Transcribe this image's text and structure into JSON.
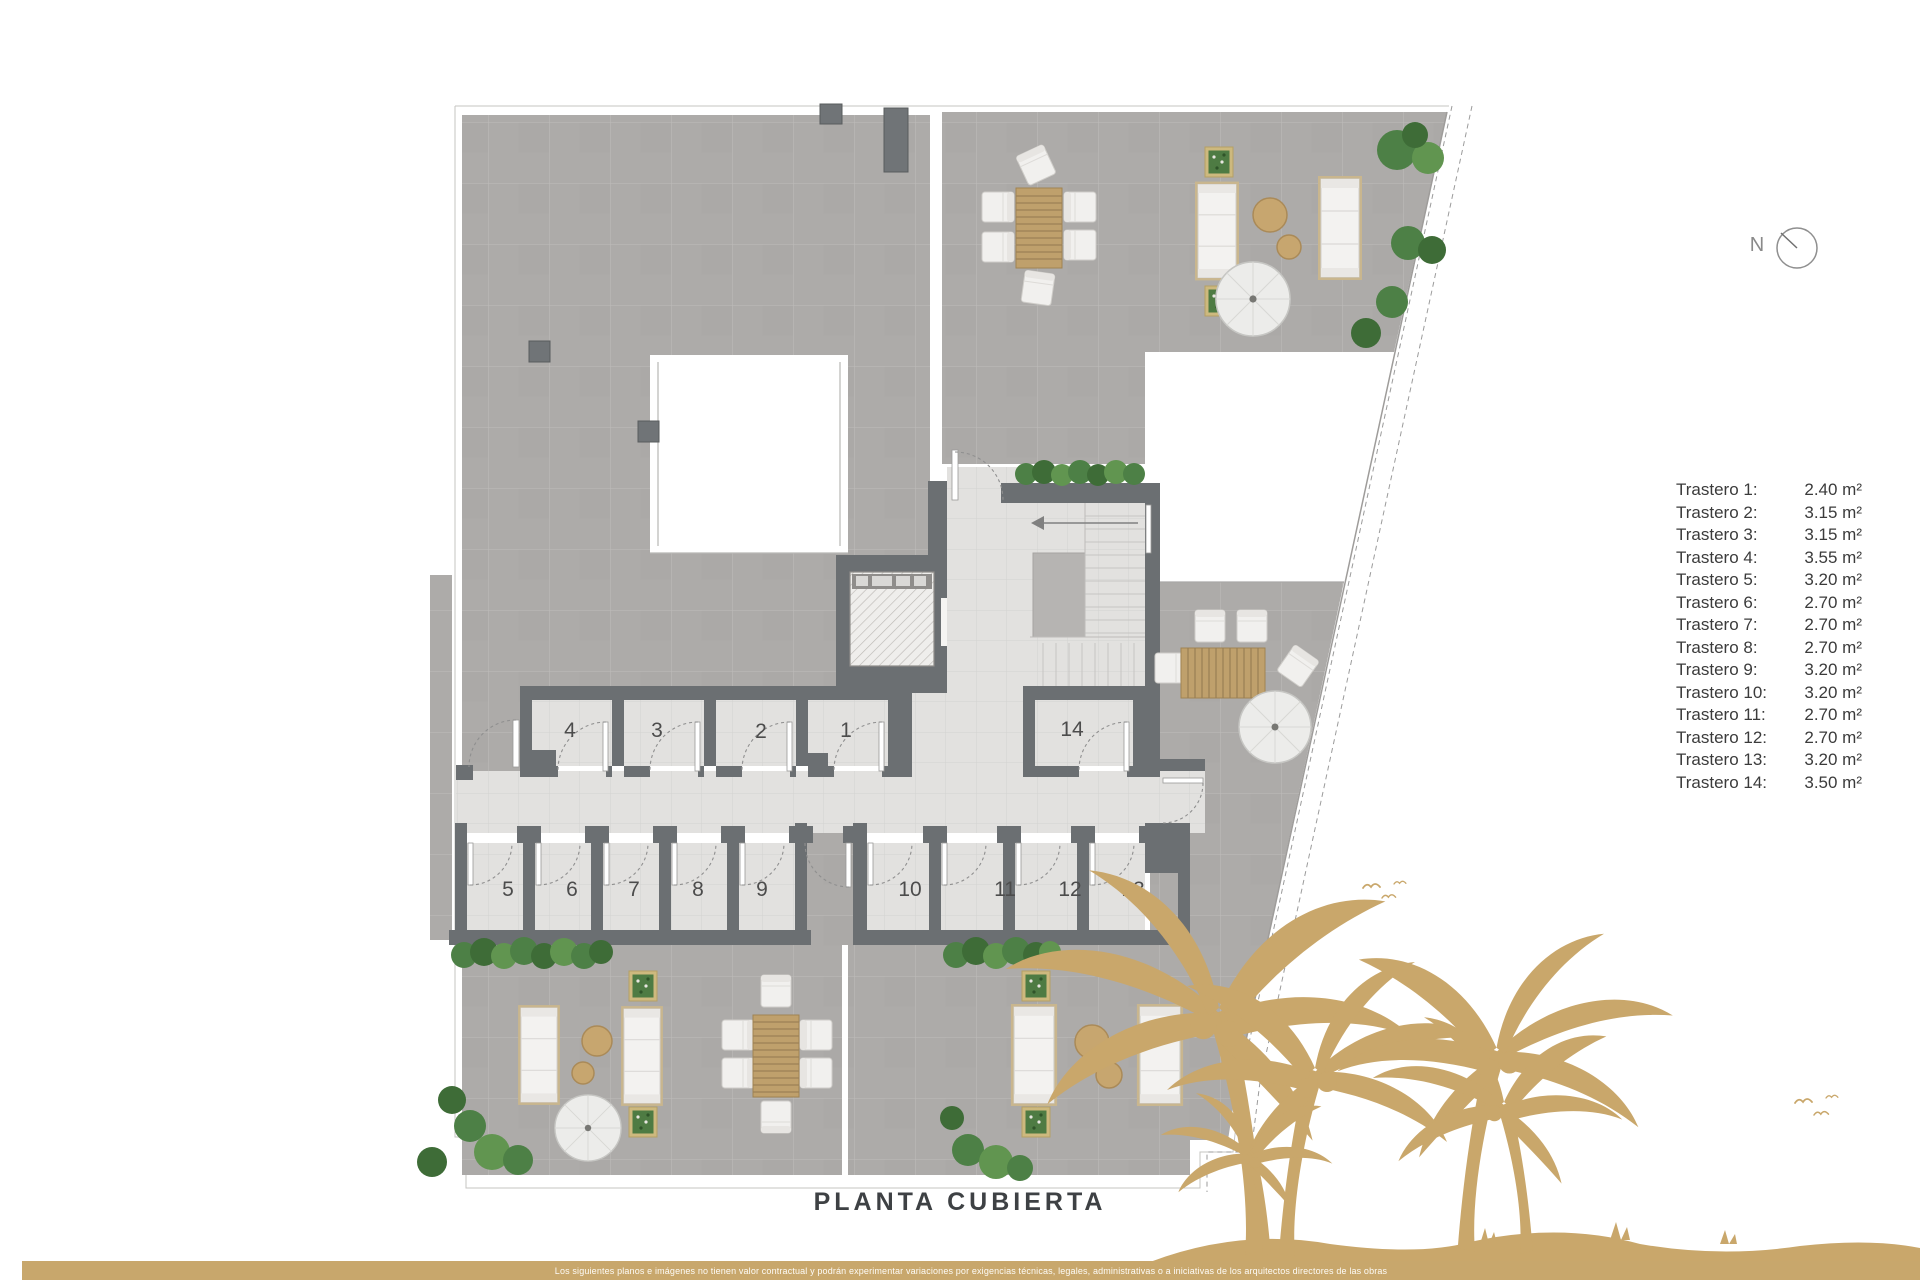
{
  "title": {
    "text": "PLANTA CUBIERTA"
  },
  "compass": {
    "label": "N"
  },
  "legend": {
    "items": [
      {
        "label": "Trastero 1:",
        "area": "2.40 m²"
      },
      {
        "label": "Trastero 2:",
        "area": "3.15 m²"
      },
      {
        "label": "Trastero 3:",
        "area": "3.15 m²"
      },
      {
        "label": "Trastero 4:",
        "area": "3.55 m²"
      },
      {
        "label": "Trastero 5:",
        "area": "3.20 m²"
      },
      {
        "label": "Trastero 6:",
        "area": "2.70 m²"
      },
      {
        "label": "Trastero 7:",
        "area": "2.70 m²"
      },
      {
        "label": "Trastero 8:",
        "area": "2.70 m²"
      },
      {
        "label": "Trastero 9:",
        "area": "3.20 m²"
      },
      {
        "label": "Trastero 10:",
        "area": "3.20 m²"
      },
      {
        "label": "Trastero 11:",
        "area": "2.70 m²"
      },
      {
        "label": "Trastero 12:",
        "area": "2.70 m²"
      },
      {
        "label": "Trastero 13:",
        "area": "3.20 m²"
      },
      {
        "label": "Trastero 14:",
        "area": "3.50 m²"
      }
    ]
  },
  "plan": {
    "name": "Planta cubierta - trasteros y terrazas",
    "room_numbers": [
      "1",
      "2",
      "3",
      "4",
      "5",
      "6",
      "7",
      "8",
      "9",
      "10",
      "11",
      "12",
      "13",
      "14"
    ]
  },
  "footer": {
    "disclaimer": "Los siguientes planos e imágenes no tienen valor contractual y podrán experimentar variaciones por exigencias técnicas, legales, administrativas o a iniciativas de los arquitectos directores de las obras"
  },
  "colors": {
    "accent": "#c9a76b",
    "wall": "#6b6f72",
    "terrace": "#adaba9",
    "floor": "#e2e1df",
    "hedge": "#4c7c42"
  }
}
